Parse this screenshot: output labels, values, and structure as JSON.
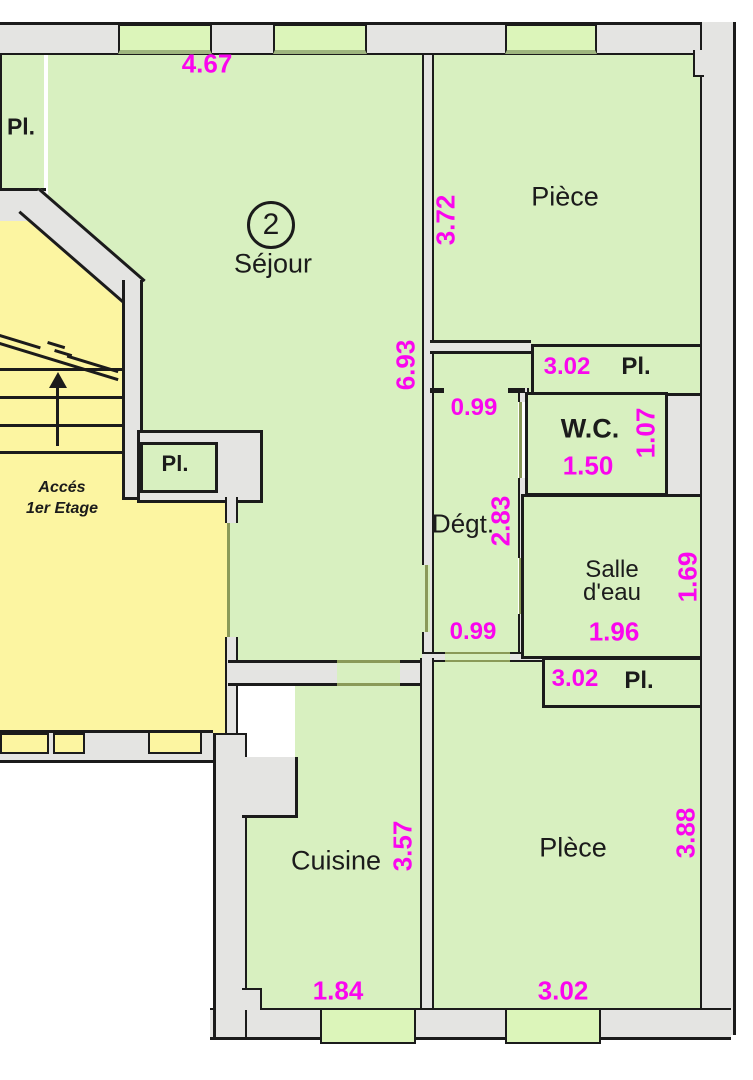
{
  "plan": {
    "colors": {
      "room_green": "#d8f0c0",
      "hall_yellow": "#fcf5a1",
      "wall_gray": "#e4e4e2",
      "line_black": "#1b1b1b",
      "dimension_magenta": "#fa06ee",
      "window_green": "#dcf5ba"
    },
    "sejour": {
      "number": "2",
      "label": "Séjour",
      "dim_width": "4.67",
      "dim_height": "6.93"
    },
    "piece_top": {
      "label": "Pièce",
      "dim_height": "3.72"
    },
    "closet_top_left": {
      "label": "Pl."
    },
    "closet_stair": {
      "label": "Pl."
    },
    "closet_upper_right": {
      "dim": "3.02",
      "label": "Pl."
    },
    "wc": {
      "label": "W.C.",
      "dim_width": "1.50",
      "dim_height": "1.07"
    },
    "degagement": {
      "label": "Dégt.",
      "dim_top": "0.99",
      "dim_height": "2.83",
      "dim_bottom": "0.99"
    },
    "salle_eau": {
      "label_line1": "Salle",
      "label_line2": "d'eau",
      "dim_width": "1.96",
      "dim_height": "1.69"
    },
    "closet_lower_right": {
      "dim": "3.02",
      "label": "Pl."
    },
    "piece_bottom": {
      "label": "Plèce",
      "dim_height": "3.88",
      "dim_width": "3.02"
    },
    "cuisine": {
      "label": "Cuisine",
      "dim_height": "3.57",
      "dim_width": "1.84"
    },
    "stairs": {
      "label_line1": "Accés",
      "label_line2": "1er Etage"
    }
  }
}
